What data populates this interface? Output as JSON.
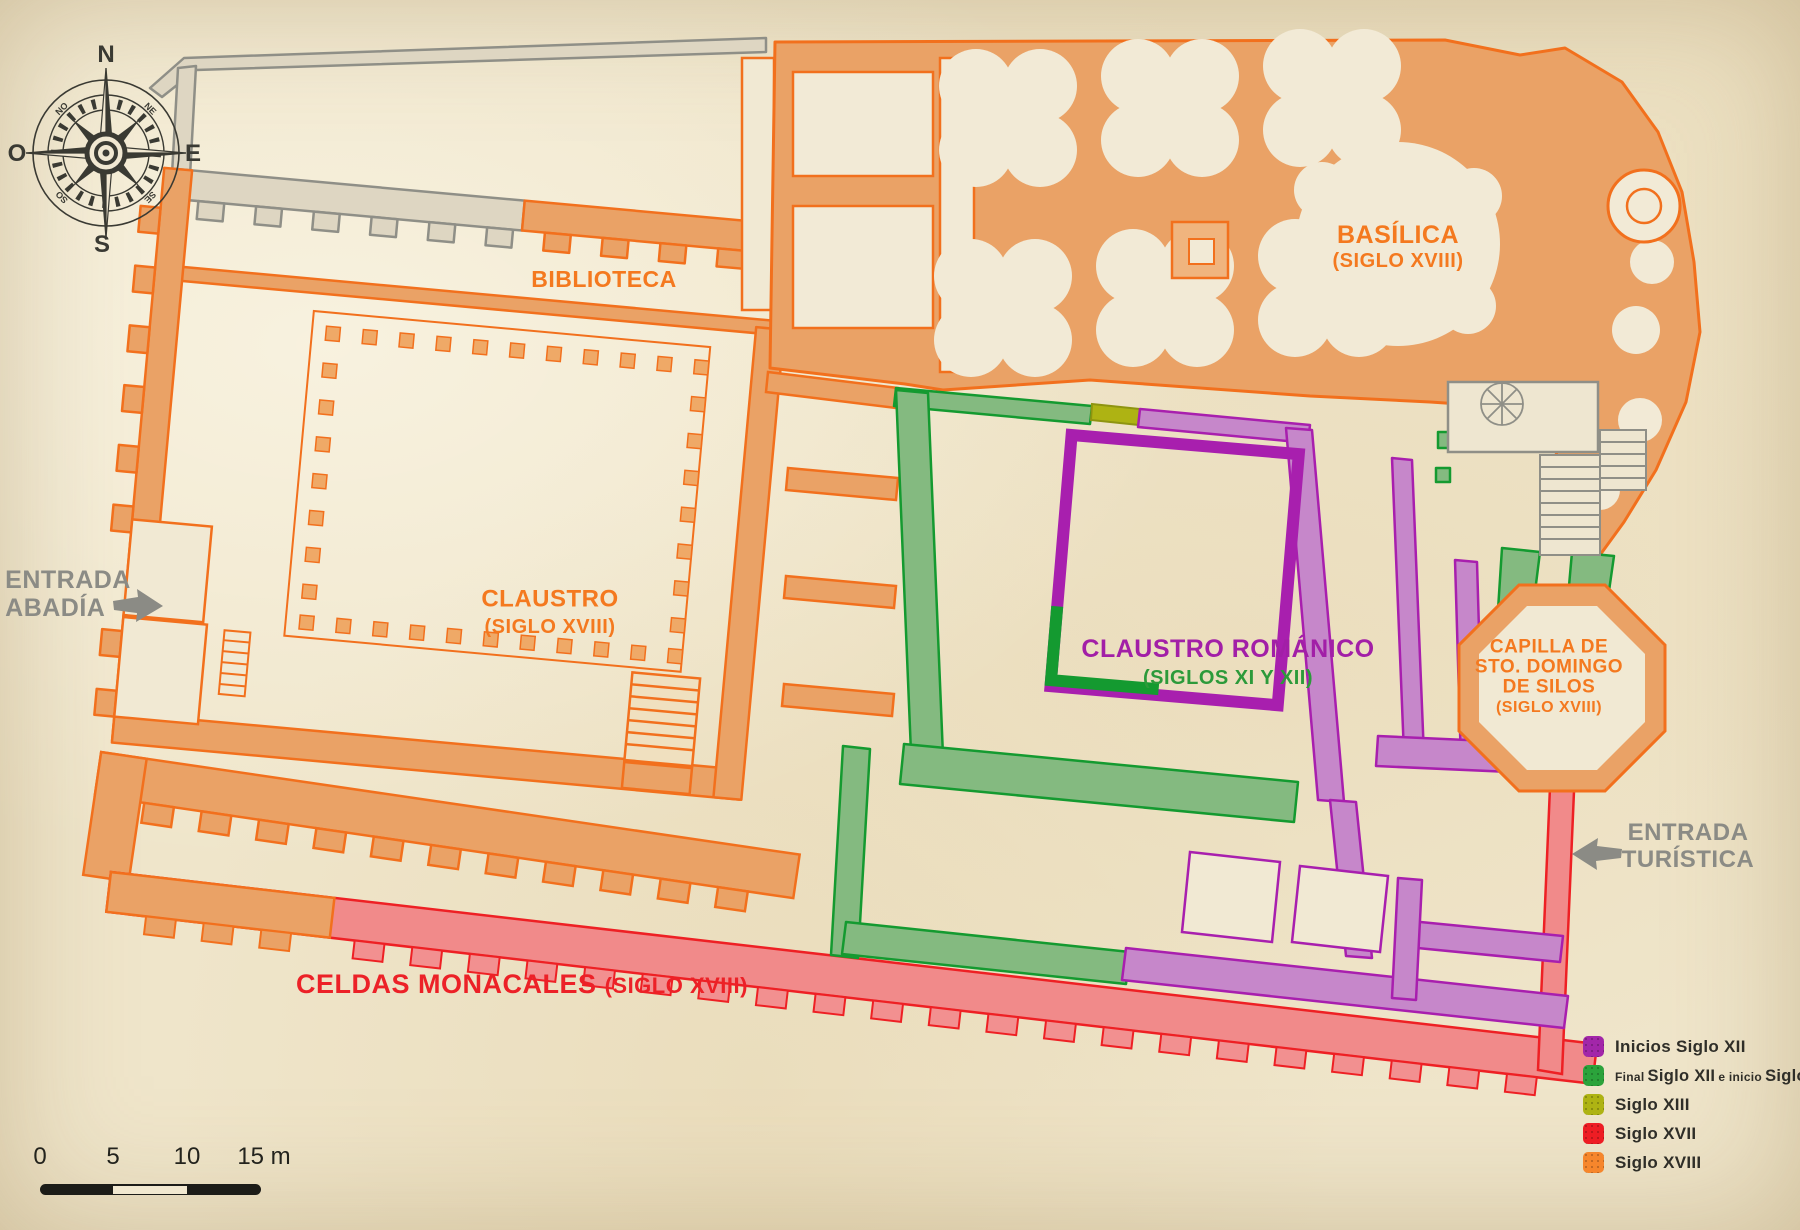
{
  "compass": {
    "n": "N",
    "s": "S",
    "e": "E",
    "o": "O",
    "ne": "NE",
    "no": "NO",
    "se": "SE",
    "so": "SO"
  },
  "labels": {
    "biblioteca": "BIBLIOTECA",
    "claustro_line1": "CLAUSTRO",
    "claustro_line2": "(SIGLO XVIII)",
    "basilica_line1": "BASÍLICA",
    "basilica_line2": "(SIGLO XVIII)",
    "romanico_line1": "CLAUSTRO ROMÁNICO",
    "romanico_line2": "(SIGLOS XI Y XII)",
    "capilla_line1": "CAPILLA DE",
    "capilla_line2": "STO. DOMINGO",
    "capilla_line3": "DE SILOS",
    "capilla_line4": "(SIGLO XVIII)",
    "celdas_main": "CELDAS MONACALES",
    "celdas_paren": "(SIGLO XVIII)",
    "entrada_abadia_line1": "ENTRADA",
    "entrada_abadia_line2": "ABADÍA",
    "entrada_turistica_line1": "ENTRADA",
    "entrada_turistica_line2": "TURÍSTICA"
  },
  "legend": {
    "items": [
      {
        "label": "Inicios Siglo XII",
        "color": "#a226a9"
      },
      {
        "parts": [
          "Final",
          "Siglo XII",
          "e inicio",
          "Siglo XIII"
        ],
        "color": "#2ba33b"
      },
      {
        "label": "Siglo XIII",
        "color": "#aeb313"
      },
      {
        "label": "Siglo XVII",
        "color": "#ee1d24"
      },
      {
        "label": "Siglo XVIII",
        "color": "#f6862c"
      }
    ]
  },
  "scalebar": {
    "ticks": [
      "0",
      "5",
      "10",
      "15 m"
    ]
  },
  "colors": {
    "parchment": "#efe5ca",
    "orange_stroke": "#f2701d",
    "orange_fill": "#eaa266",
    "orange_text": "#f4791f",
    "red_stroke": "#ee2024",
    "red_fill": "#f18a8a",
    "red_text": "#ec2127",
    "green_stroke": "#149a30",
    "green_fill": "#84ba80",
    "green_text": "#2c9a3a",
    "purple_stroke": "#a81fae",
    "purple_fill": "#c687ca",
    "purple_text": "#a21fa7",
    "olive": "#aeb313",
    "gray_stroke": "#8f8f87",
    "gray_fill": "#ded6c2",
    "gray_text": "#8b8b85",
    "dark_text": "#2f2e28"
  }
}
